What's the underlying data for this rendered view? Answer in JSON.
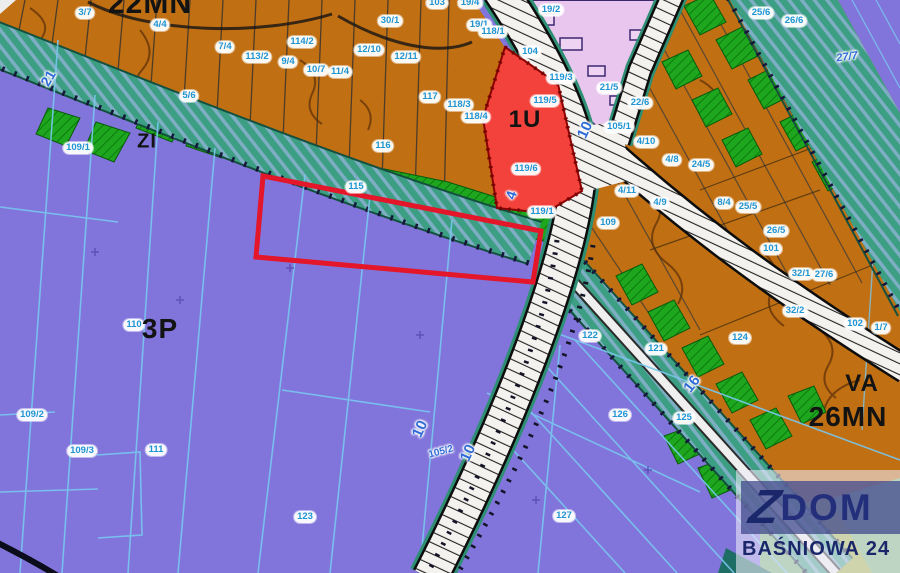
{
  "map": {
    "type": "zoning-plan-map",
    "zone_labels": [
      {
        "text": "22MN",
        "x": 150,
        "y": 4,
        "size": 30
      },
      {
        "text": "ZI",
        "x": 147,
        "y": 142,
        "size": 20
      },
      {
        "text": "3P",
        "x": 160,
        "y": 329,
        "size": 28
      },
      {
        "text": "1U",
        "x": 525,
        "y": 120,
        "size": 24
      },
      {
        "text": "VA",
        "x": 862,
        "y": 384,
        "size": 24
      },
      {
        "text": "26MN",
        "x": 848,
        "y": 417,
        "size": 28
      }
    ],
    "parcel_labels": [
      {
        "text": "3/7",
        "x": 85,
        "y": 13
      },
      {
        "text": "4/4",
        "x": 160,
        "y": 25
      },
      {
        "text": "7/4",
        "x": 225,
        "y": 47
      },
      {
        "text": "113/2",
        "x": 257,
        "y": 57
      },
      {
        "text": "9/4",
        "x": 288,
        "y": 62
      },
      {
        "text": "114/2",
        "x": 302,
        "y": 42
      },
      {
        "text": "30/1",
        "x": 390,
        "y": 21
      },
      {
        "text": "12/10",
        "x": 369,
        "y": 50
      },
      {
        "text": "12/11",
        "x": 406,
        "y": 57
      },
      {
        "text": "10/7",
        "x": 316,
        "y": 70
      },
      {
        "text": "11/4",
        "x": 340,
        "y": 72
      },
      {
        "text": "5/6",
        "x": 189,
        "y": 96
      },
      {
        "text": "117",
        "x": 430,
        "y": 97
      },
      {
        "text": "118/3",
        "x": 459,
        "y": 105
      },
      {
        "text": "118/4",
        "x": 476,
        "y": 117
      },
      {
        "text": "116",
        "x": 383,
        "y": 146
      },
      {
        "text": "115",
        "x": 356,
        "y": 187
      },
      {
        "text": "103",
        "x": 437,
        "y": 3
      },
      {
        "text": "19/4",
        "x": 470,
        "y": 3
      },
      {
        "text": "19/1",
        "x": 479,
        "y": 25
      },
      {
        "text": "19/2",
        "x": 551,
        "y": 10
      },
      {
        "text": "118/1",
        "x": 493,
        "y": 32
      },
      {
        "text": "104",
        "x": 530,
        "y": 52
      },
      {
        "text": "119/3",
        "x": 561,
        "y": 78
      },
      {
        "text": "21/5",
        "x": 609,
        "y": 88
      },
      {
        "text": "22/6",
        "x": 640,
        "y": 103
      },
      {
        "text": "119/5",
        "x": 545,
        "y": 101
      },
      {
        "text": "119/6",
        "x": 526,
        "y": 169
      },
      {
        "text": "119/1",
        "x": 542,
        "y": 212
      },
      {
        "text": "105/1",
        "x": 619,
        "y": 127
      },
      {
        "text": "4/10",
        "x": 646,
        "y": 142
      },
      {
        "text": "4/8",
        "x": 672,
        "y": 160
      },
      {
        "text": "24/5",
        "x": 701,
        "y": 165
      },
      {
        "text": "4/11",
        "x": 627,
        "y": 191
      },
      {
        "text": "4/9",
        "x": 660,
        "y": 203
      },
      {
        "text": "109",
        "x": 608,
        "y": 223
      },
      {
        "text": "8/4",
        "x": 724,
        "y": 203
      },
      {
        "text": "25/5",
        "x": 748,
        "y": 207
      },
      {
        "text": "26/5",
        "x": 776,
        "y": 231
      },
      {
        "text": "101",
        "x": 771,
        "y": 249
      },
      {
        "text": "32/1",
        "x": 801,
        "y": 274
      },
      {
        "text": "27/6",
        "x": 824,
        "y": 275
      },
      {
        "text": "32/2",
        "x": 795,
        "y": 311
      },
      {
        "text": "102",
        "x": 855,
        "y": 324
      },
      {
        "text": "1/7",
        "x": 881,
        "y": 328
      },
      {
        "text": "25/6",
        "x": 761,
        "y": 13
      },
      {
        "text": "26/6",
        "x": 794,
        "y": 21
      },
      {
        "text": "109/1",
        "x": 78,
        "y": 148
      },
      {
        "text": "110",
        "x": 134,
        "y": 325
      },
      {
        "text": "109/2",
        "x": 32,
        "y": 415
      },
      {
        "text": "109/3",
        "x": 82,
        "y": 451
      },
      {
        "text": "111",
        "x": 156,
        "y": 450
      },
      {
        "text": "123",
        "x": 305,
        "y": 517
      },
      {
        "text": "127",
        "x": 564,
        "y": 516
      },
      {
        "text": "122",
        "x": 590,
        "y": 336
      },
      {
        "text": "121",
        "x": 656,
        "y": 349
      },
      {
        "text": "124",
        "x": 740,
        "y": 338
      },
      {
        "text": "126",
        "x": 620,
        "y": 415
      },
      {
        "text": "125",
        "x": 684,
        "y": 418
      }
    ],
    "road_labels": [
      {
        "text": "10",
        "x": 585,
        "y": 130,
        "rot": -65,
        "size": 15
      },
      {
        "text": "10",
        "x": 420,
        "y": 429,
        "rot": -65,
        "size": 15
      },
      {
        "text": "10",
        "x": 468,
        "y": 453,
        "rot": -65,
        "size": 15
      },
      {
        "text": "16",
        "x": 692,
        "y": 384,
        "rot": -52,
        "size": 15
      },
      {
        "text": "21",
        "x": 48,
        "y": 78,
        "rot": -60,
        "size": 14
      },
      {
        "text": "4",
        "x": 511,
        "y": 195,
        "rot": -72,
        "size": 14
      },
      {
        "text": "105/2",
        "x": 441,
        "y": 452,
        "rot": -15,
        "size": 10
      },
      {
        "text": "27/7",
        "x": 847,
        "y": 57,
        "rot": -8,
        "size": 11,
        "italic": true
      }
    ],
    "colors": {
      "purple": "#8175DC",
      "orange": "#C06F12",
      "green": "#1EA71E",
      "teal_band": "#3C9E83",
      "pink": "#E9C6EE",
      "red_zone": "#F3423C",
      "selection_red": "#E3162A",
      "parcel_label_blue": "#1F95D4",
      "road_label_blue": "#2F6BD7",
      "brand_navy": "#232F7A"
    }
  },
  "watermark": {
    "brand_z": "Z",
    "brand_name": "DOM",
    "subtitle": "BAŚNIOWA 24"
  }
}
